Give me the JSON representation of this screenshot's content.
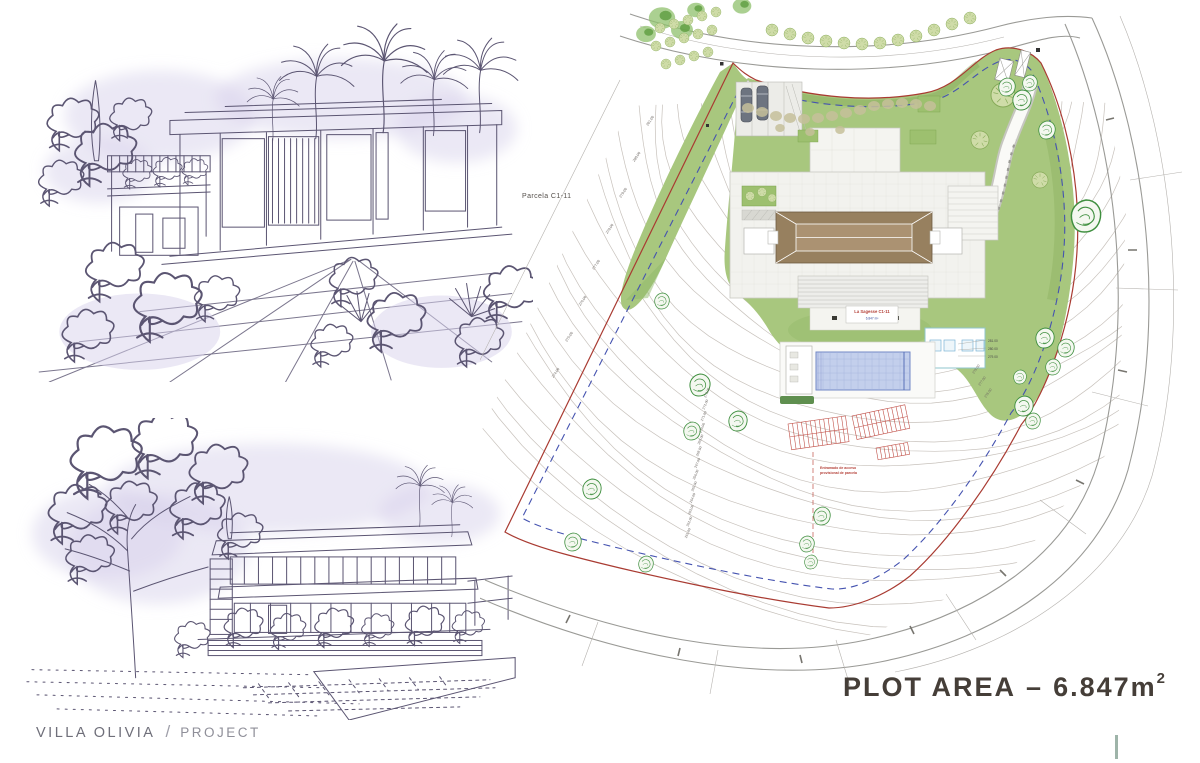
{
  "footer": {
    "project": "VILLA OLIVIA",
    "divider": "/",
    "label": "PROJECT"
  },
  "plot_area": {
    "label": "PLOT AREA",
    "dash": "–",
    "value": "6.847m",
    "sup": "2"
  },
  "site_plan": {
    "parcel_label": "Parcela C1-11",
    "plot_tag_line1": "La Sagesse C1-11",
    "plot_tag_line2": "6.847 m²",
    "hatch_note_line1": "Entramado de acceso",
    "hatch_note_line2": "provisional de parcela",
    "contours_left": [
      "281.00",
      "280.00",
      "279.00",
      "278.00",
      "277.00",
      "276.00",
      "275.00",
      "274.00"
    ],
    "contours_center": [
      "273.00",
      "272.00",
      "271.00",
      "270.00",
      "269.00",
      "268.00",
      "267.00",
      "266.00",
      "265.00",
      "264.00",
      "263.00",
      "262.00",
      "261.00"
    ],
    "pool_levels": [
      "281.00",
      "280.00",
      "279.00"
    ],
    "slope_levels": [
      "278.00",
      "277.00",
      "276.00"
    ],
    "colors": {
      "boundary_red": "#a93b32",
      "setback_blue": "#4553b0",
      "lawn_green": "#a8c77e",
      "pool_blue": "#c3cfec",
      "roof_brown": "#97805f",
      "contour_gray": "#beb7b0",
      "accent_tick": "#9eb4a9"
    }
  },
  "sketches": {
    "top_name": "villa-front-perspective-sketch",
    "bottom_name": "villa-side-perspective-sketch"
  }
}
